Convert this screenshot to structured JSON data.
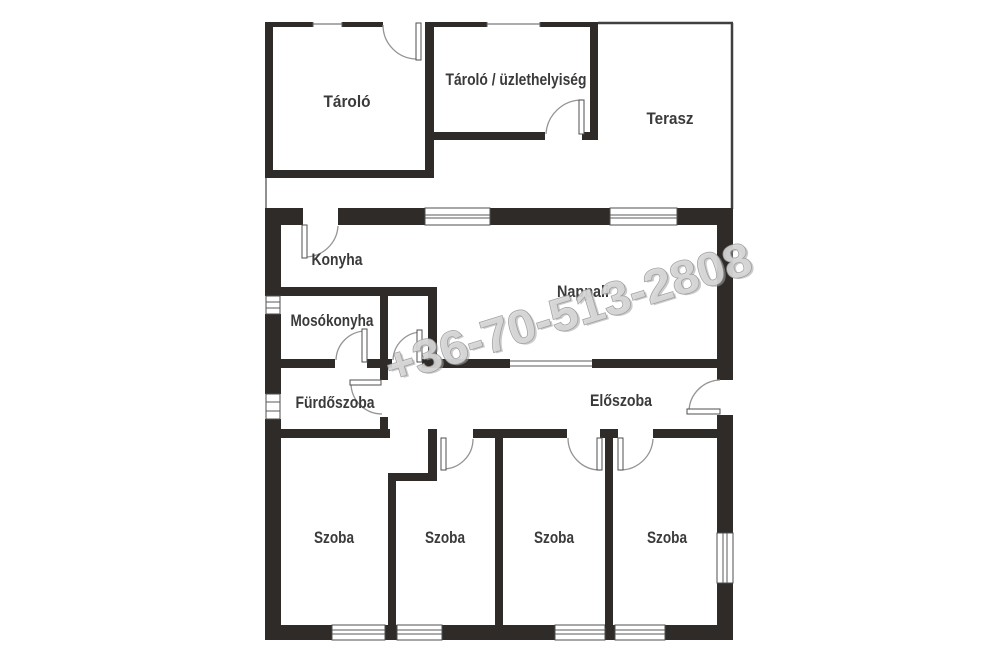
{
  "plan": {
    "type": "floor-plan",
    "watermark": {
      "text": "+36-70-513-2808"
    },
    "rooms": [
      {
        "id": "tarolo",
        "label": "Tároló"
      },
      {
        "id": "tarolo-uzlethelyiseg",
        "label": "Tároló / üzlethelyiség"
      },
      {
        "id": "terasz",
        "label": "Terasz"
      },
      {
        "id": "konyha",
        "label": "Konyha"
      },
      {
        "id": "nappali",
        "label": "Nappali"
      },
      {
        "id": "mosokonyha",
        "label": "Mosókonyha"
      },
      {
        "id": "furdoszoba",
        "label": "Fürdőszoba"
      },
      {
        "id": "eloszoba",
        "label": "Előszoba"
      },
      {
        "id": "szoba-1",
        "label": "Szoba"
      },
      {
        "id": "szoba-2",
        "label": "Szoba"
      },
      {
        "id": "szoba-3",
        "label": "Szoba"
      },
      {
        "id": "szoba-4",
        "label": "Szoba"
      }
    ],
    "colors": {
      "wall": "#2f2b29",
      "label": "#3a3a3a",
      "door_arc": "#949494",
      "watermark_fill": "#d6d6d6",
      "watermark_outline": "#979797",
      "background": "#ffffff"
    }
  }
}
